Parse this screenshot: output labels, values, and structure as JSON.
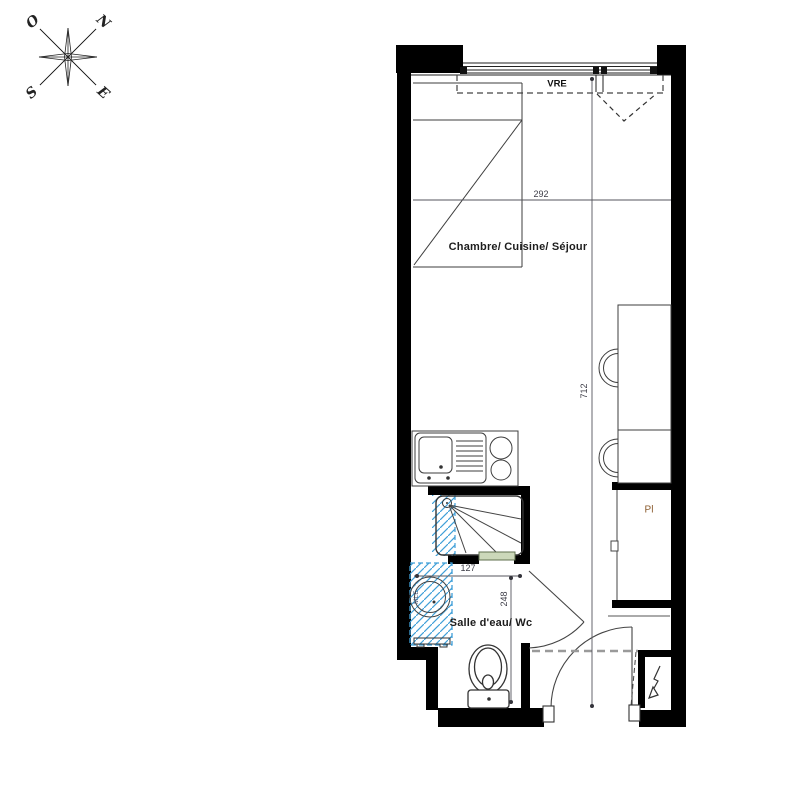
{
  "compass": {
    "west": "O",
    "north": "N",
    "south": "S",
    "east": "E"
  },
  "window": {
    "shutter_label": "VRE"
  },
  "rooms": {
    "main": {
      "label": "Chambre/ Cuisine/ Séjour"
    },
    "bathroom": {
      "label": "Salle d'eau/ Wc"
    }
  },
  "fixtures": {
    "closet_label": "Pl",
    "washing_machine_label": "MLE"
  },
  "dimensions": {
    "room_width_cm": "292",
    "room_length_cm": "712",
    "shower_width_cm": "127",
    "bathroom_depth_cm": "248"
  },
  "colors": {
    "wall": "#000000",
    "furniture_line": "#3d3d3d",
    "hatch_blue": "#3f9fd8",
    "sill_green_fill": "#ccd8ba",
    "sill_green_border": "#5f6f4e",
    "closet_label_color": "#8a5a2c",
    "dashed_gray": "#9a9a9a"
  }
}
